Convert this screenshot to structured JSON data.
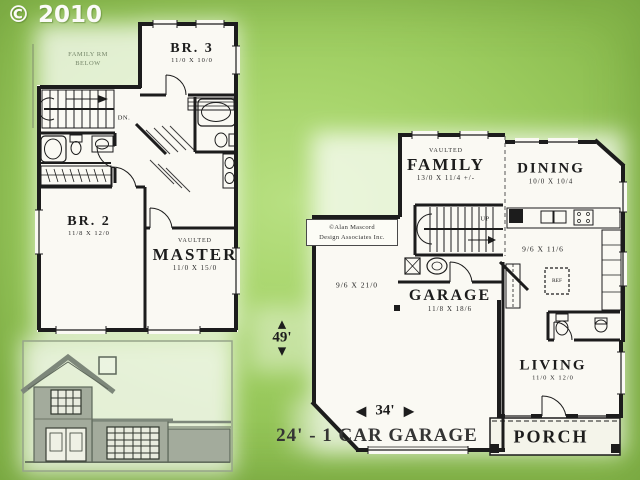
{
  "copyright": "© 2010",
  "upper_floor": {
    "family_below_line1": "FAMILY RM",
    "family_below_line2": "BELOW",
    "down_label": "DN.",
    "br3_name": "BR. 3",
    "br3_dims": "11/0 X 10/0",
    "br2_name": "BR. 2",
    "br2_dims": "11/8 X 12/0",
    "master_prefix": "VAULTED",
    "master_name": "MASTER",
    "master_dims": "11/0 X 15/0"
  },
  "main_floor": {
    "watermark_line1": "©Alan Mascord",
    "watermark_line2": "Design Associates Inc.",
    "family_prefix": "VAULTED",
    "family_name": "FAMILY",
    "family_dims": "13/0 X 11/4 +/-",
    "dining_name": "DINING",
    "dining_dims": "10/0 X 10/4",
    "up_label": "UP",
    "kitchen_dims": "9/6 X 11/6",
    "ref_label": "REF",
    "storage_dims": "9/6 X 21/0",
    "garage_name": "GARAGE",
    "garage_dims": "11/8 X 18/6",
    "living_name": "LIVING",
    "living_dims": "11/0 X 12/0",
    "porch_name": "PORCH"
  },
  "dimensions": {
    "depth_label": "49'",
    "width_label": "34'",
    "garage_width_label": "24' - 1 CAR GARAGE",
    "arrow_up": "▲",
    "arrow_down": "▼",
    "arrow_left": "◀",
    "arrow_right": "▶"
  },
  "colors": {
    "background_green": "#a8d56c",
    "plan_white": "#faf9f3",
    "wall_black": "#1c1c1c",
    "elevation_gray": "#a3ab9c"
  }
}
